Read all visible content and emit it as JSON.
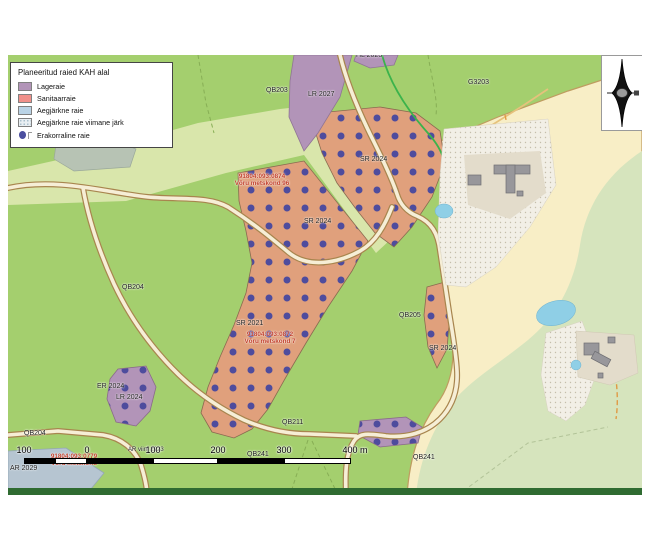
{
  "map_title": "Planeeritud raied KAH alal",
  "legend": {
    "title": "Planeeritud raied KAH alal",
    "items": [
      {
        "label": "Lageraie",
        "type": "fill",
        "color": "#b294b8"
      },
      {
        "label": "Sanitaarraie",
        "type": "fill",
        "color": "#f0908a"
      },
      {
        "label": "Aegjärkne raie",
        "type": "fill",
        "color": "#bad3e6"
      },
      {
        "label": "Aegjärkne raie viimane järk",
        "type": "fill-dotted",
        "color": "#e9eff3"
      },
      {
        "label": "Erakorraline raie",
        "type": "point",
        "color": "#4c4f9f"
      }
    ]
  },
  "map": {
    "labels": [
      {
        "text": "HL 2023",
        "x": 348,
        "y": -3
      },
      {
        "text": "QB203",
        "x": 258,
        "y": 32
      },
      {
        "text": "LR 2027",
        "x": 300,
        "y": 36
      },
      {
        "text": "G3203",
        "x": 460,
        "y": 24
      },
      {
        "text": "SR 2024",
        "x": 352,
        "y": 101
      },
      {
        "text": "91804:093:0874\nVõru metskond 96",
        "x": 254,
        "y": 118,
        "red": true
      },
      {
        "text": "SR 2024",
        "x": 296,
        "y": 163
      },
      {
        "text": "QB204",
        "x": 114,
        "y": 229
      },
      {
        "text": "QB205",
        "x": 391,
        "y": 257
      },
      {
        "text": "SR 2021",
        "x": 228,
        "y": 265
      },
      {
        "text": "91804:093:0872\nVõru metskond 7",
        "x": 262,
        "y": 276,
        "red": true
      },
      {
        "text": "SR 2024",
        "x": 421,
        "y": 290
      },
      {
        "text": "ER 2024",
        "x": 89,
        "y": 328
      },
      {
        "text": "LR 2024",
        "x": 108,
        "y": 339
      },
      {
        "text": "QB211",
        "x": 274,
        "y": 364
      },
      {
        "text": "QB204",
        "x": 16,
        "y": 375
      },
      {
        "text": "AR viim 2023",
        "x": 120,
        "y": 392,
        "small": true
      },
      {
        "text": "QB241",
        "x": 239,
        "y": 396
      },
      {
        "text": "91804:093:0779\nVõru metskond",
        "x": 66,
        "y": 398,
        "red": true
      },
      {
        "text": "QB241",
        "x": 405,
        "y": 399
      },
      {
        "text": "AR 2029",
        "x": 2,
        "y": 410
      }
    ],
    "colors": {
      "forest_green": "#a4cf6e",
      "pale_band_green": "#d9e6ab",
      "field_yellow": "#f8eec6",
      "pale_forest": "#d6e4bd",
      "harvest_fill": "#e0a07c",
      "harvest_dot": "#4e4c9d",
      "clearcut_purple": "#b294b8",
      "shelterwood_gray_blue": "#b6c5d1",
      "water_blue": "#8fcfe6",
      "road_fill": "#f6eed6",
      "road_edge": "#a8854e",
      "dark_green_strip": "#2f6b31",
      "building_gray": "#98979b"
    }
  },
  "scalebar": {
    "ticks": [
      {
        "label": "100",
        "x": 16
      },
      {
        "label": "0",
        "x": 79
      },
      {
        "label": "100",
        "x": 145
      },
      {
        "label": "200",
        "x": 210
      },
      {
        "label": "300",
        "x": 276
      },
      {
        "label": "400 m",
        "x": 347
      }
    ],
    "segments": [
      {
        "x": 16,
        "w": 31,
        "f": "#000000"
      },
      {
        "x": 47,
        "w": 32,
        "f": "#ffffff"
      },
      {
        "x": 79,
        "w": 66,
        "f": "#000000"
      },
      {
        "x": 145,
        "w": 65,
        "f": "#ffffff"
      },
      {
        "x": 210,
        "w": 66,
        "f": "#000000"
      },
      {
        "x": 276,
        "w": 67,
        "f": "#ffffff"
      }
    ]
  }
}
